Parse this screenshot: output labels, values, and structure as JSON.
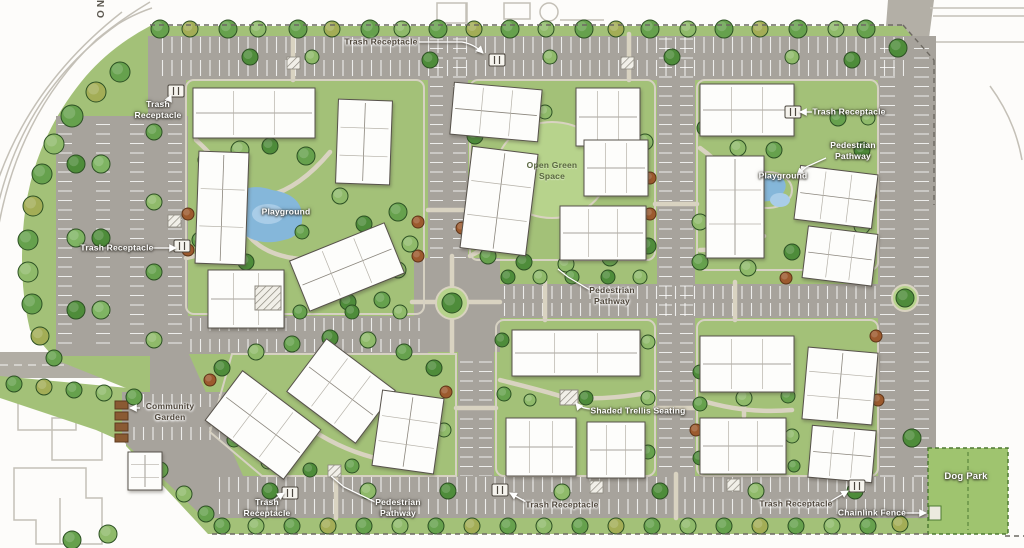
{
  "labels": {
    "trash_receptacle": "Trash Receptacle",
    "playground": "Playground",
    "open_green_space": "Open Green Space",
    "pedestrian_pathway": "Pedestrian Pathway",
    "community_garden": "Community Garden",
    "shaded_trellis_seating": "Shaded Trellis Seating",
    "dog_park": "Dog Park",
    "chainlink_fence": "Chainlink Fence",
    "street_partial": "NO"
  },
  "colors": {
    "asphalt": "#a7a39c",
    "lawn": "#a3c178",
    "lawn_light": "#b7d38c",
    "building": "#fdfdfb",
    "playground_water": "#85b7da",
    "label_dark": "#4f473c",
    "label_light": "#ffffff",
    "garden_bed": "#8a5a33",
    "dog_park_green": "#9fc46f",
    "tree_stroke": "#2d5124"
  }
}
